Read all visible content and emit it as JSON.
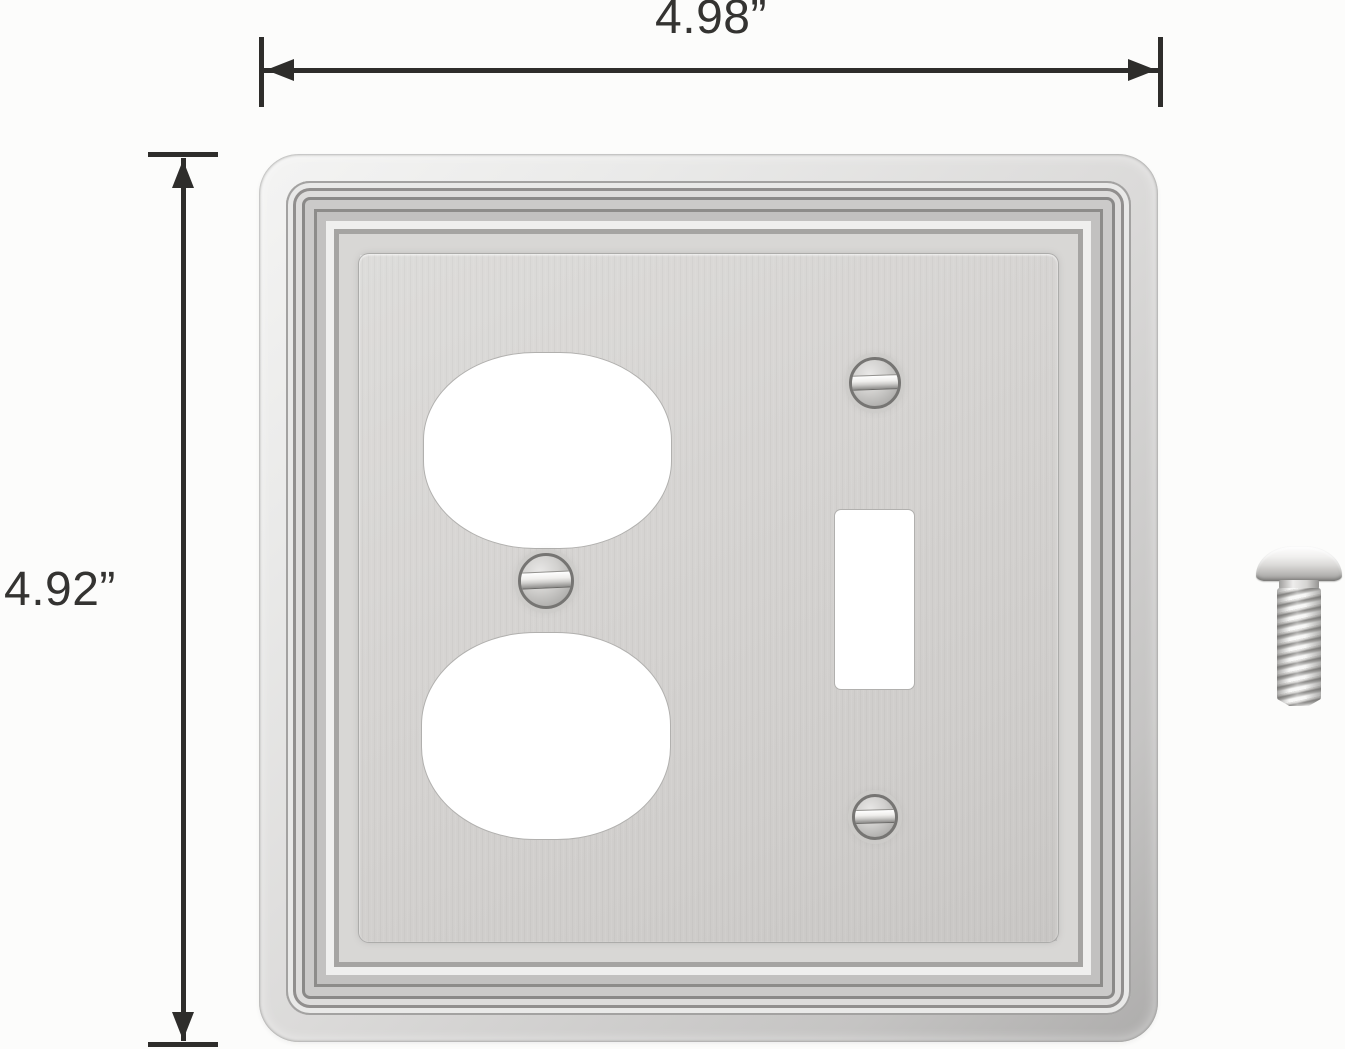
{
  "canvas": {
    "width_px": 1345,
    "height_px": 1049,
    "background_color": "#fcfcfb"
  },
  "annotations": {
    "width_dimension_label": "4.98”",
    "height_dimension_label": "4.92”",
    "line_color": "#2e2d2b",
    "label_color": "#343331"
  },
  "plate": {
    "finish": "brushed nickel (silver)",
    "colors": {
      "highlight": "#f4f4f3",
      "mid": "#d8d7d5",
      "shadow": "#adacab",
      "ridge_dark": "#8a8988",
      "ridge_light": "#efefee",
      "panel": "#d4d2d0",
      "opening_fill": "#ffffff",
      "opening_edge": "#b1b0ae",
      "screw_ring": "#767573"
    },
    "openings": [
      "duplex-outlet",
      "toggle-switch"
    ],
    "plate_screw_count": 3
  },
  "loose_screw": {
    "color": "#d8d7d5"
  }
}
